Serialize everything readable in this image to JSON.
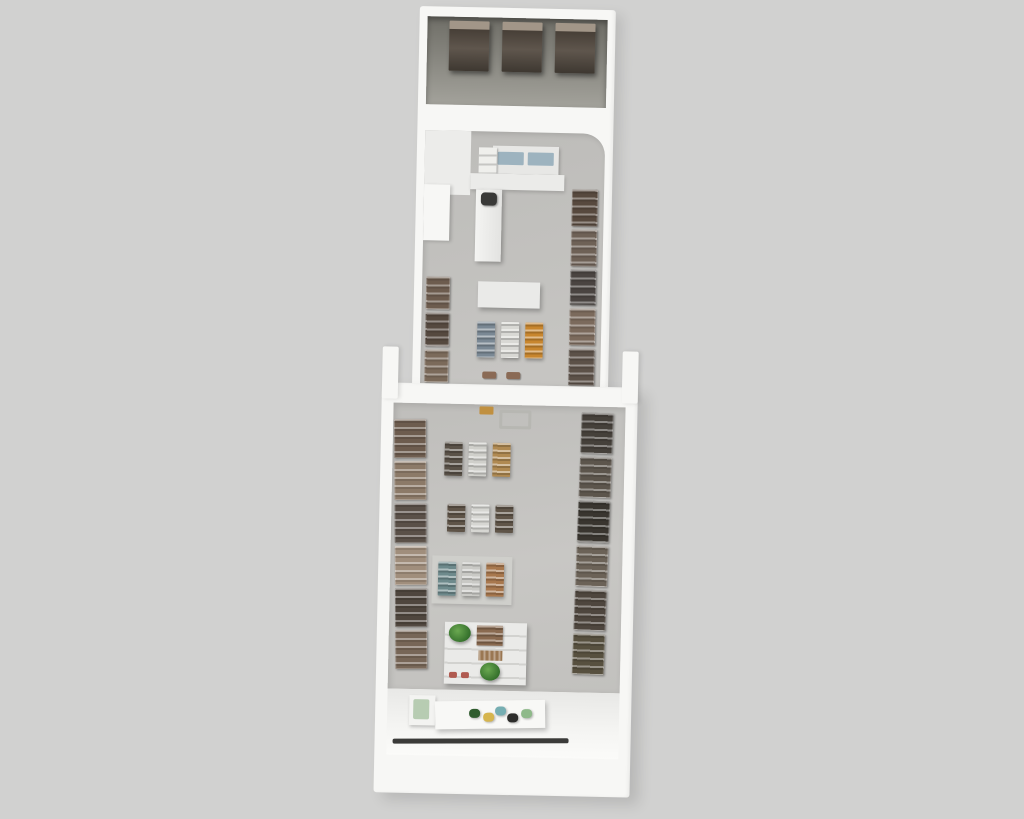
{
  "scene": {
    "background": "#d1d1d0",
    "building_tilt_deg": 1.2
  },
  "palette": {
    "bg": "#d1d1d0",
    "wall": "#f7f7f5",
    "floor_storage": "#83827b",
    "floor_concrete": "#c2c1be",
    "floor_entrance": "#f1f1ef",
    "strip": "#3b3b39",
    "register": "#3a3a38",
    "checkout_items": "#9db3bf",
    "plant": "#35702c",
    "rack_brown": "#5f564d"
  },
  "fixtures": {
    "storage_racks": {
      "count": 3,
      "color": "#5f564d"
    },
    "wall_shelves": {
      "office_right": {
        "units": 5,
        "colors": [
          "#57493e",
          "#6e6156",
          "#4a4441",
          "#7b6a5c",
          "#5c5148"
        ]
      },
      "office_left": {
        "units": 3,
        "colors": [
          "#6d5c4e",
          "#55493f",
          "#7b6a5a"
        ]
      },
      "main_left": {
        "units": 6,
        "colors": [
          "#6d5c4e",
          "#8c7a68",
          "#5a5048",
          "#a08e7c",
          "#4f463e",
          "#776657"
        ]
      },
      "main_right": {
        "units": 6,
        "colors": [
          "#45403a",
          "#5c554c",
          "#39352f",
          "#6b6257",
          "#4e463e",
          "#57503f"
        ]
      }
    },
    "display_clusters": {
      "checkout_cluster": {
        "colors": [
          "#7a8894",
          "#d8d8d4",
          "#c8862e"
        ]
      },
      "cluster_1": {
        "colors": [
          "#5a5248",
          "#cfcfca",
          "#b08a52"
        ]
      },
      "cluster_2": {
        "colors": [
          "#5f5448",
          "#d6d6d2",
          "#5f5448"
        ]
      },
      "cluster_3": {
        "colors": [
          "#6e8a8c",
          "#c9c9c5",
          "#a8784e"
        ]
      }
    },
    "entrance_products": {
      "colors": [
        "#2f5c2e",
        "#d6b54e",
        "#76aeb2",
        "#2d2d2b",
        "#8fb98a"
      ]
    }
  }
}
